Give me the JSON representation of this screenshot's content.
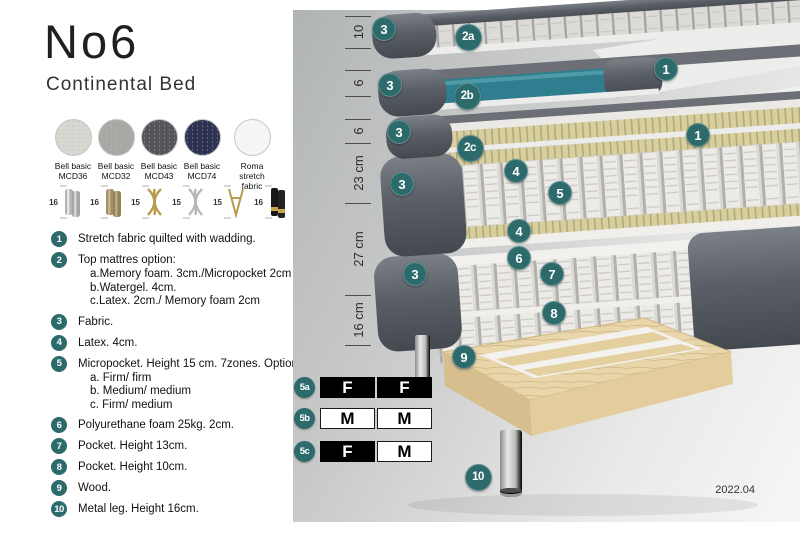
{
  "header": {
    "title": "No6",
    "subtitle": "Continental Bed"
  },
  "colors": {
    "accent_teal": "#2c6a6b",
    "watergel_teal": "#2f7e8f",
    "cover_gray": "#5a5e66",
    "wood": "#e9d6ab"
  },
  "fabrics": [
    {
      "name": "Bell basic",
      "code": "MCD36",
      "color": "#d9d7d2",
      "textured": true
    },
    {
      "name": "Bell basic",
      "code": "MCD32",
      "color": "#a9a8a4",
      "textured": true
    },
    {
      "name": "Bell basic",
      "code": "MCD43",
      "color": "#54555a",
      "textured": true
    },
    {
      "name": "Bell basic",
      "code": "MCD74",
      "color": "#2d3252",
      "textured": true
    },
    {
      "name": "Roma",
      "code": "stretch fabric",
      "color": "#f5f5f4",
      "textured": false
    }
  ],
  "legs": [
    {
      "height": "16",
      "style": "cylinder-silver"
    },
    {
      "height": "16",
      "style": "cylinder-bronze"
    },
    {
      "height": "15",
      "style": "cross-gold"
    },
    {
      "height": "15",
      "style": "cross-silver"
    },
    {
      "height": "15",
      "style": "hairpin-gold"
    },
    {
      "height": "16",
      "style": "cylinder-black-gold"
    }
  ],
  "legend": [
    {
      "num": "1",
      "text": "Stretch fabric quilted with wadding."
    },
    {
      "num": "2",
      "text": "Top mattres option:",
      "sub": [
        "a.Memory foam. 3cm./Micropocket 2cm",
        "b.Watergel. 4cm.",
        "c.Latex. 2cm./ Memory foam 2cm"
      ]
    },
    {
      "num": "3",
      "text": "Fabric."
    },
    {
      "num": "4",
      "text": "Latex. 4cm."
    },
    {
      "num": "5",
      "text": "Micropocket. Height 15 cm. 7zones. Option:",
      "sub": [
        "a. Firm/ firm",
        "b. Medium/ medium",
        "c. Firm/ medium"
      ]
    },
    {
      "num": "6",
      "text": "Polyurethane foam 25kg. 2cm."
    },
    {
      "num": "7",
      "text": "Pocket. Height 13cm."
    },
    {
      "num": "8",
      "text": "Pocket. Height 10cm."
    },
    {
      "num": "9",
      "text": "Wood."
    },
    {
      "num": "10",
      "text": "Metal leg. Height 16cm."
    }
  ],
  "diagram": {
    "measurements": [
      {
        "label": "10",
        "from": 16,
        "to": 48
      },
      {
        "label": "6",
        "from": 70,
        "to": 96
      },
      {
        "label": "6",
        "from": 119,
        "to": 143
      },
      {
        "label": "23 cm",
        "from": 143,
        "to": 203
      },
      {
        "label": "27 cm",
        "from": 203,
        "to": 295
      },
      {
        "label": "16 cm",
        "from": 295,
        "to": 345
      }
    ],
    "callouts": [
      {
        "label": "3",
        "x": 90,
        "y": 28
      },
      {
        "label": "2a",
        "x": 174,
        "y": 36
      },
      {
        "label": "1",
        "x": 372,
        "y": 68
      },
      {
        "label": "3",
        "x": 96,
        "y": 84
      },
      {
        "label": "2b",
        "x": 173,
        "y": 95
      },
      {
        "label": "3",
        "x": 105,
        "y": 131
      },
      {
        "label": "2c",
        "x": 176,
        "y": 147
      },
      {
        "label": "1",
        "x": 404,
        "y": 134
      },
      {
        "label": "3",
        "x": 108,
        "y": 183
      },
      {
        "label": "4",
        "x": 222,
        "y": 170
      },
      {
        "label": "5",
        "x": 266,
        "y": 192
      },
      {
        "label": "4",
        "x": 225,
        "y": 230
      },
      {
        "label": "6",
        "x": 225,
        "y": 257
      },
      {
        "label": "7",
        "x": 258,
        "y": 273
      },
      {
        "label": "3",
        "x": 121,
        "y": 273
      },
      {
        "label": "8",
        "x": 260,
        "y": 312
      },
      {
        "label": "9",
        "x": 170,
        "y": 356
      },
      {
        "label": "10",
        "x": 184,
        "y": 476
      }
    ],
    "firmness": [
      {
        "label": "5a",
        "y": 377,
        "cells": [
          {
            "text": "F",
            "filled": true
          },
          {
            "text": "F",
            "filled": true
          }
        ]
      },
      {
        "label": "5b",
        "y": 408,
        "cells": [
          {
            "text": "M",
            "filled": false
          },
          {
            "text": "M",
            "filled": false
          }
        ]
      },
      {
        "label": "5c",
        "y": 441,
        "cells": [
          {
            "text": "F",
            "filled": true
          },
          {
            "text": "M",
            "filled": false
          }
        ]
      }
    ],
    "version": "2022.04"
  }
}
